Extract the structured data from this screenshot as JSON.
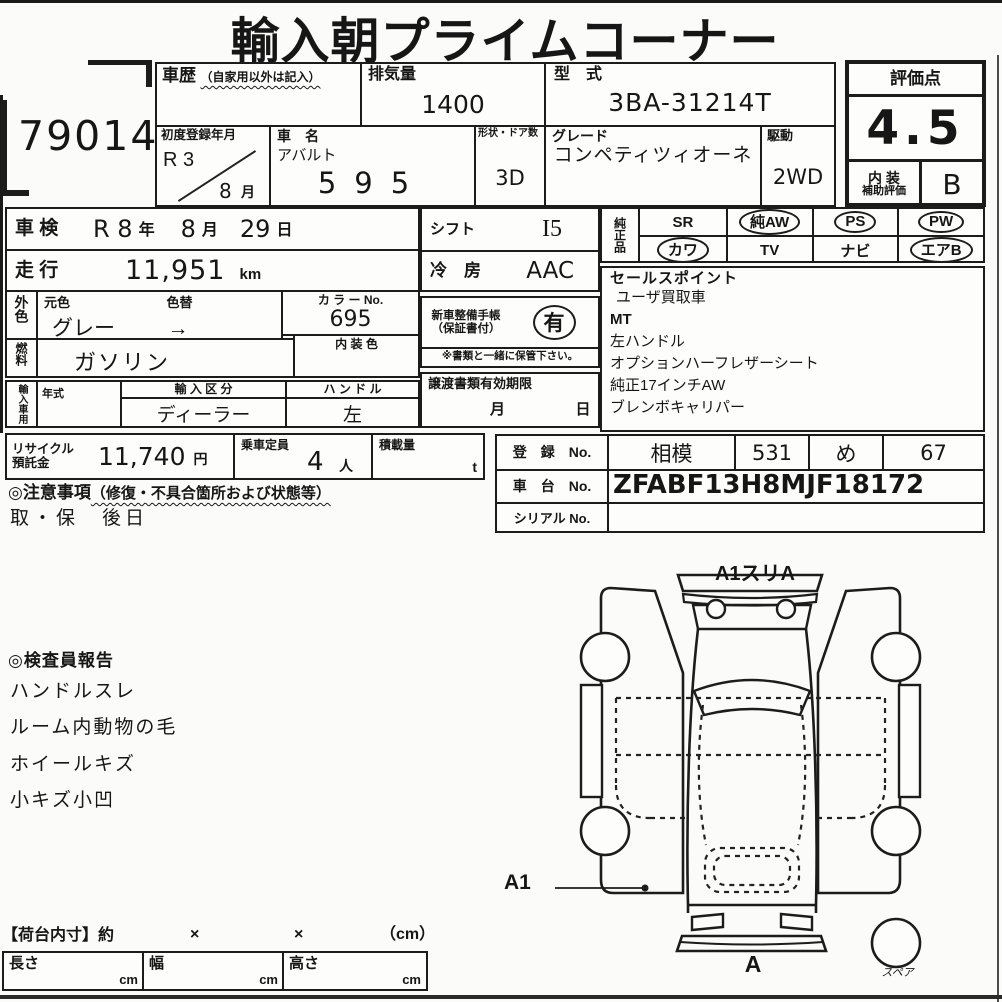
{
  "title": "輸入朝プライムコーナー",
  "lot_number": "79014",
  "top_table": {
    "history": {
      "label": "車歴",
      "note": "（自家用以外は記入）",
      "value": ""
    },
    "displacement": {
      "label": "排気量",
      "value": "1400"
    },
    "model_code": {
      "label": "型　式",
      "value": "3BA-31214T"
    },
    "first_registration": {
      "label": "初度登録年月",
      "era_year": "R 3",
      "month": "8",
      "month_suffix": "月"
    },
    "car_name": {
      "label": "車　名",
      "make": "アバルト",
      "model": "595"
    },
    "body_doors": {
      "label": "形状・ドア数",
      "value": "3D"
    },
    "grade": {
      "label": "グレード",
      "value": "コンペティツィオーネ"
    },
    "drive": {
      "label": "駆動",
      "value": "2WD"
    }
  },
  "score": {
    "label": "評価点",
    "value": "4.5",
    "interior_label_1": "内 装",
    "interior_label_2": "補助評価",
    "interior_value": "B"
  },
  "inspection": {
    "label": "車 検",
    "era_year": "R 8",
    "year_suffix": "年",
    "month": "8",
    "month_suffix": "月",
    "day": "29",
    "day_suffix": "日"
  },
  "mileage": {
    "label": "走 行",
    "value": "11,951",
    "unit": "km"
  },
  "exterior": {
    "side_label": "外色",
    "orig_label": "元色",
    "change_label": "色替",
    "orig_value": "グレー",
    "arrow": "→",
    "color_no_label": "カ ラ ー No.",
    "color_no": "695"
  },
  "fuel": {
    "side_label": "燃料",
    "value": "ガソリン",
    "interior_color_label": "内 装 色",
    "interior_color_value": ""
  },
  "import_info": {
    "side_label": "輸入車用",
    "year_label": "年式",
    "year_value": "",
    "division_label": "輸 入 区 分",
    "division_value": "ディーラー",
    "handle_label": "ハ ン ド ル",
    "handle_value": "左"
  },
  "shift": {
    "label": "シフト",
    "value": "I5"
  },
  "aircon": {
    "label": "冷　房",
    "value": "AAC"
  },
  "service_book": {
    "label_1": "新車整備手帳",
    "label_2": "（保証書付）",
    "value": "有",
    "note": "※書類と一緒に保管下さい。"
  },
  "transfer_docs": {
    "label": "譲渡書類有効期限",
    "month_label": "月",
    "day_label": "日"
  },
  "genuine_parts": {
    "side_label": "純正品",
    "items": [
      {
        "name": "SR",
        "circled": false
      },
      {
        "name": "純AW",
        "circled": true
      },
      {
        "name": "PS",
        "circled": true
      },
      {
        "name": "PW",
        "circled": true
      },
      {
        "name": "カワ",
        "circled": true
      },
      {
        "name": "TV",
        "circled": false
      },
      {
        "name": "ナビ",
        "circled": false
      },
      {
        "name": "エアB",
        "circled": true
      }
    ]
  },
  "sales_points": {
    "label": "セールスポイント",
    "items": [
      "ユーザ買取車",
      "MT",
      "左ハンドル",
      "オプションハーフレザーシート",
      "純正17インチAW",
      "ブレンボキャリパー"
    ]
  },
  "recycle": {
    "label_1": "リサイクル",
    "label_2": "預託金",
    "value": "11,740",
    "unit": "円"
  },
  "capacity": {
    "label": "乗車定員",
    "value": "4",
    "unit": "人"
  },
  "load": {
    "label": "積載量",
    "value": "",
    "unit": "t"
  },
  "registration": {
    "reg_label": "登　録　No.",
    "reg_values": [
      "相模",
      "531",
      "め",
      "67"
    ],
    "chassis_label": "車　台　No.",
    "chassis_value": "ZFABF13H8MJF18172",
    "serial_label": "シリアル No.",
    "serial_value": ""
  },
  "cautions": {
    "heading": "◎注意事項",
    "note": "（修復・不具合箇所および状態等）",
    "body": "取・保　後日"
  },
  "inspector_report": {
    "heading": "◎検査員報告",
    "items": [
      "ハンドルスレ",
      "ルーム内動物の毛",
      "ホイールキズ",
      "小キズ小凹"
    ]
  },
  "diagram": {
    "top_label": "A1スリA",
    "left_label": "A1",
    "bottom_label": "A",
    "spare_label": "スペア"
  },
  "cargo": {
    "label": "【荷台内寸】約",
    "x1": "×",
    "x2": "×",
    "unit": "（cm）",
    "cols": [
      {
        "label": "長さ",
        "unit": "cm",
        "value": ""
      },
      {
        "label": "幅",
        "unit": "cm",
        "value": ""
      },
      {
        "label": "高さ",
        "unit": "cm",
        "value": ""
      }
    ]
  }
}
